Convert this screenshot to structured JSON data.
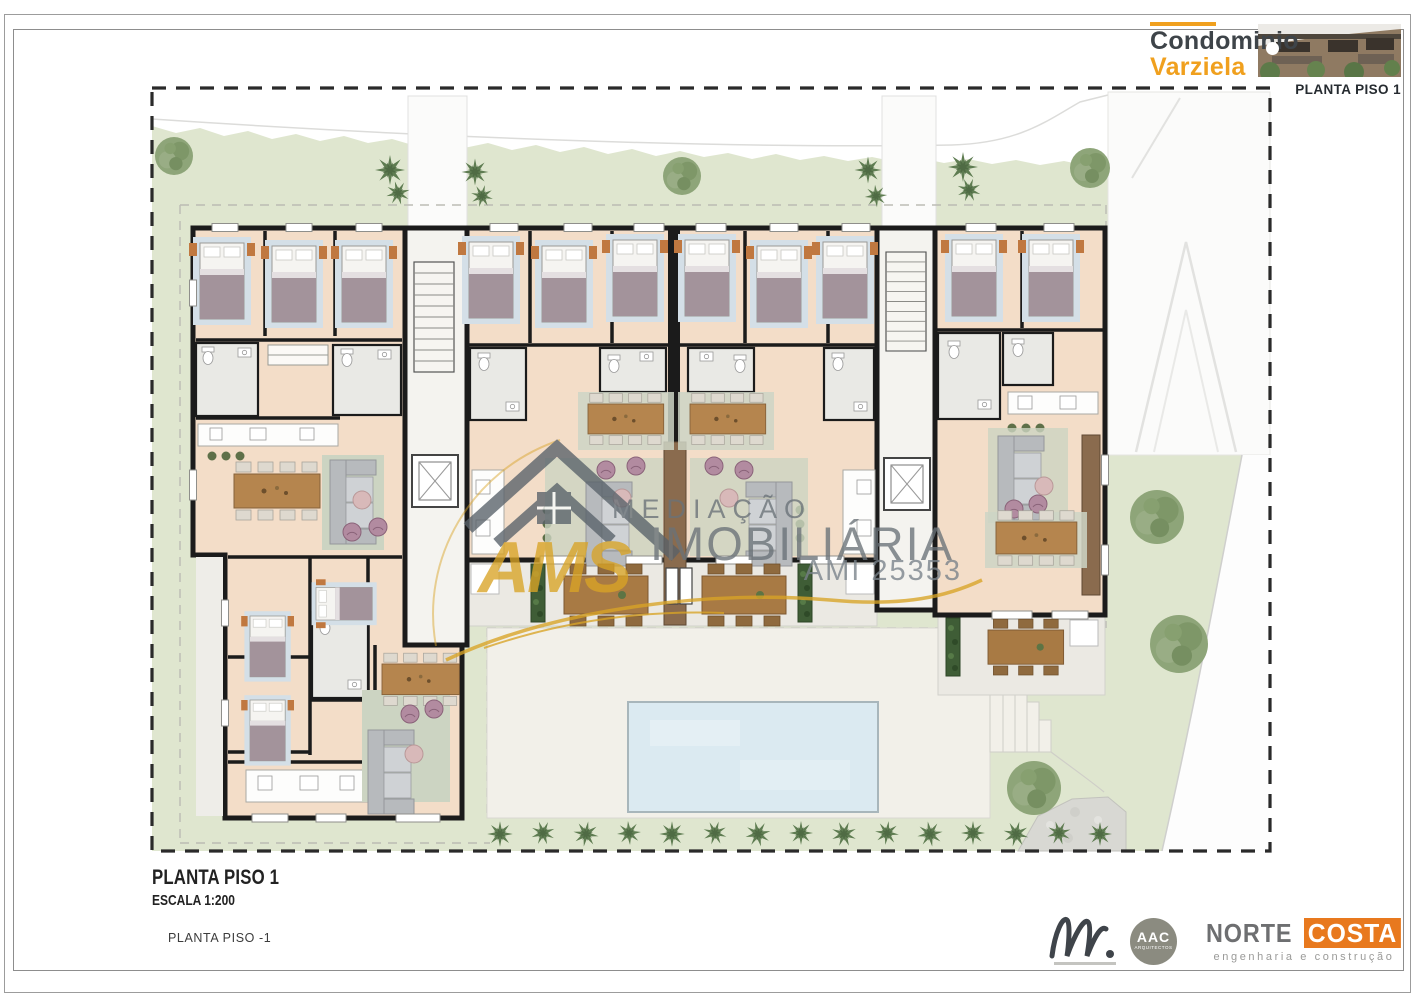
{
  "header": {
    "brand_top": "Condominio",
    "brand_bottom": "Varziela",
    "sheet": "PLANTA PISO 1"
  },
  "watermark": {
    "logo": "AMS",
    "word1": "MEDIAÇÃO",
    "word2": "IMOBILIÁRIA",
    "license": "AMI 25353"
  },
  "titleblock": {
    "title": "PLANTA PISO 1",
    "scale": "ESCALA 1:200",
    "note": "PLANTA PISO -1"
  },
  "logos": {
    "aac_top": "AAC",
    "aac_bottom": "ARQUITECTOS",
    "nc_left": "NORTE",
    "nc_right": "COSTA",
    "nc_tagline": "engenharia e construção"
  },
  "colors": {
    "brand_orange": "#F0A01E",
    "nortecosta_orange": "#E8791E",
    "grass_green": "#DFE6CF",
    "floor_peach": "#F3DDC8",
    "pool_blue": "#DBEAF1",
    "wall_black": "#1B1B1B",
    "watermark_gray": "#6A7278",
    "watermark_gold": "#D9A426"
  }
}
